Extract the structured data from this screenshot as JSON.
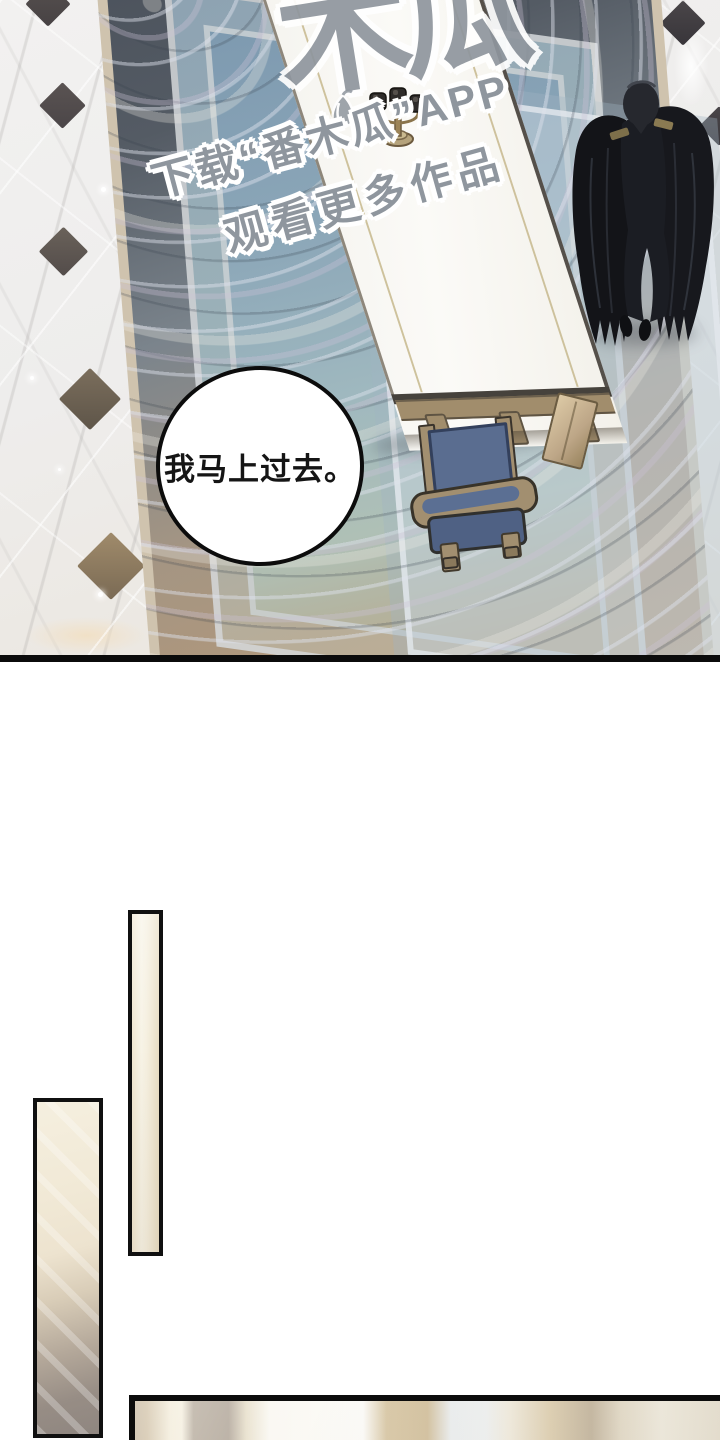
{
  "panel1": {
    "speech_bubble": {
      "text": "我马上过去。"
    },
    "watermark": {
      "logo": "木瓜",
      "line1": "下载“番木瓜”APP",
      "line2": "观看更多作品"
    },
    "colors": {
      "panel_border": "#0b0b0b",
      "marble_floor": "#efedec",
      "floor_diamond_dark": "#4e484a",
      "floor_diamond_warm": "#8a7860",
      "carpet_border_slate": "#49505a",
      "carpet_field_blue": "#8ba6b8",
      "carpet_tan": "#b49878",
      "table_white": "#f8f7f3",
      "table_inlay_gold": "#c9bb92",
      "chair_wood": "#a28f70",
      "chair_cushion_blue": "#54678a",
      "character_black": "#17181d",
      "epaulette_gold": "#8a7a52",
      "watermark_gray": "#8f969e",
      "wall_marble_cream": "#f2ebd8"
    }
  }
}
